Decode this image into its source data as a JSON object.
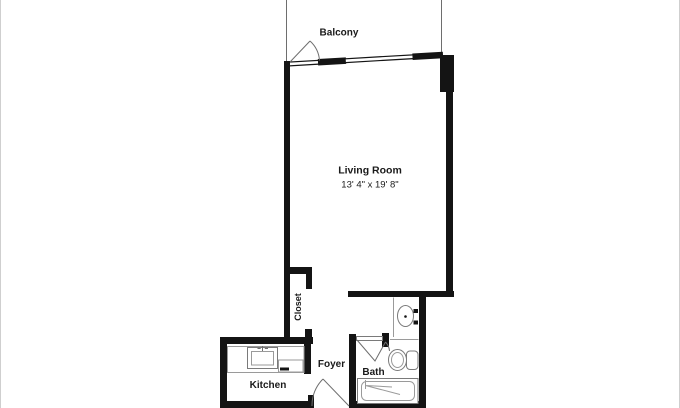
{
  "colors": {
    "bg": "#ffffff",
    "wall": "#141414",
    "line": "#6e6e6e",
    "fixture": "#7a7a7a",
    "fixture-light": "#9a9a9a",
    "text": "#1a1a1a",
    "edge": "#cfcfcf"
  },
  "floorplan": {
    "type": "apartment-floor-plan",
    "rooms": {
      "balcony": {
        "label": "Balcony"
      },
      "living_room": {
        "label": "Living Room",
        "dimensions": "13' 4\" x 19' 8\""
      },
      "closet": {
        "label": "Closet"
      },
      "kitchen": {
        "label": "Kitchen"
      },
      "foyer": {
        "label": "Foyer"
      },
      "bath": {
        "label": "Bath"
      }
    },
    "fixtures": [
      "balcony-door-swing",
      "entry-door-swing",
      "bath-door-swing",
      "kitchen-counter",
      "kitchen-sink",
      "dishwasher",
      "bath-vanity-sink",
      "toilet",
      "bathtub"
    ]
  }
}
